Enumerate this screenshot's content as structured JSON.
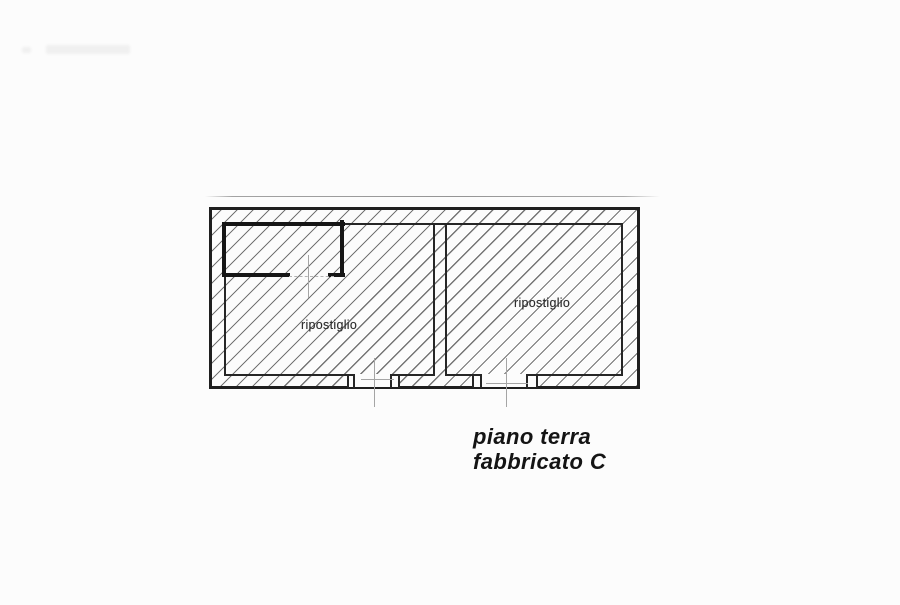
{
  "document": {
    "type": "scanned-floor-plan",
    "rooms": [
      {
        "position": "left",
        "label": "ripostiglio"
      },
      {
        "position": "right",
        "label": "ripostiglio"
      }
    ],
    "caption": {
      "line1": "piano terra",
      "line2": "fabbricato C"
    },
    "colors": {
      "paper": "#fcfcfc",
      "wall_line": "#1f1f1f",
      "hatch_line": "#747474",
      "axis_line": "#a5a5a5",
      "label_text": "#2d2d2d",
      "caption_text": "#141414"
    }
  }
}
